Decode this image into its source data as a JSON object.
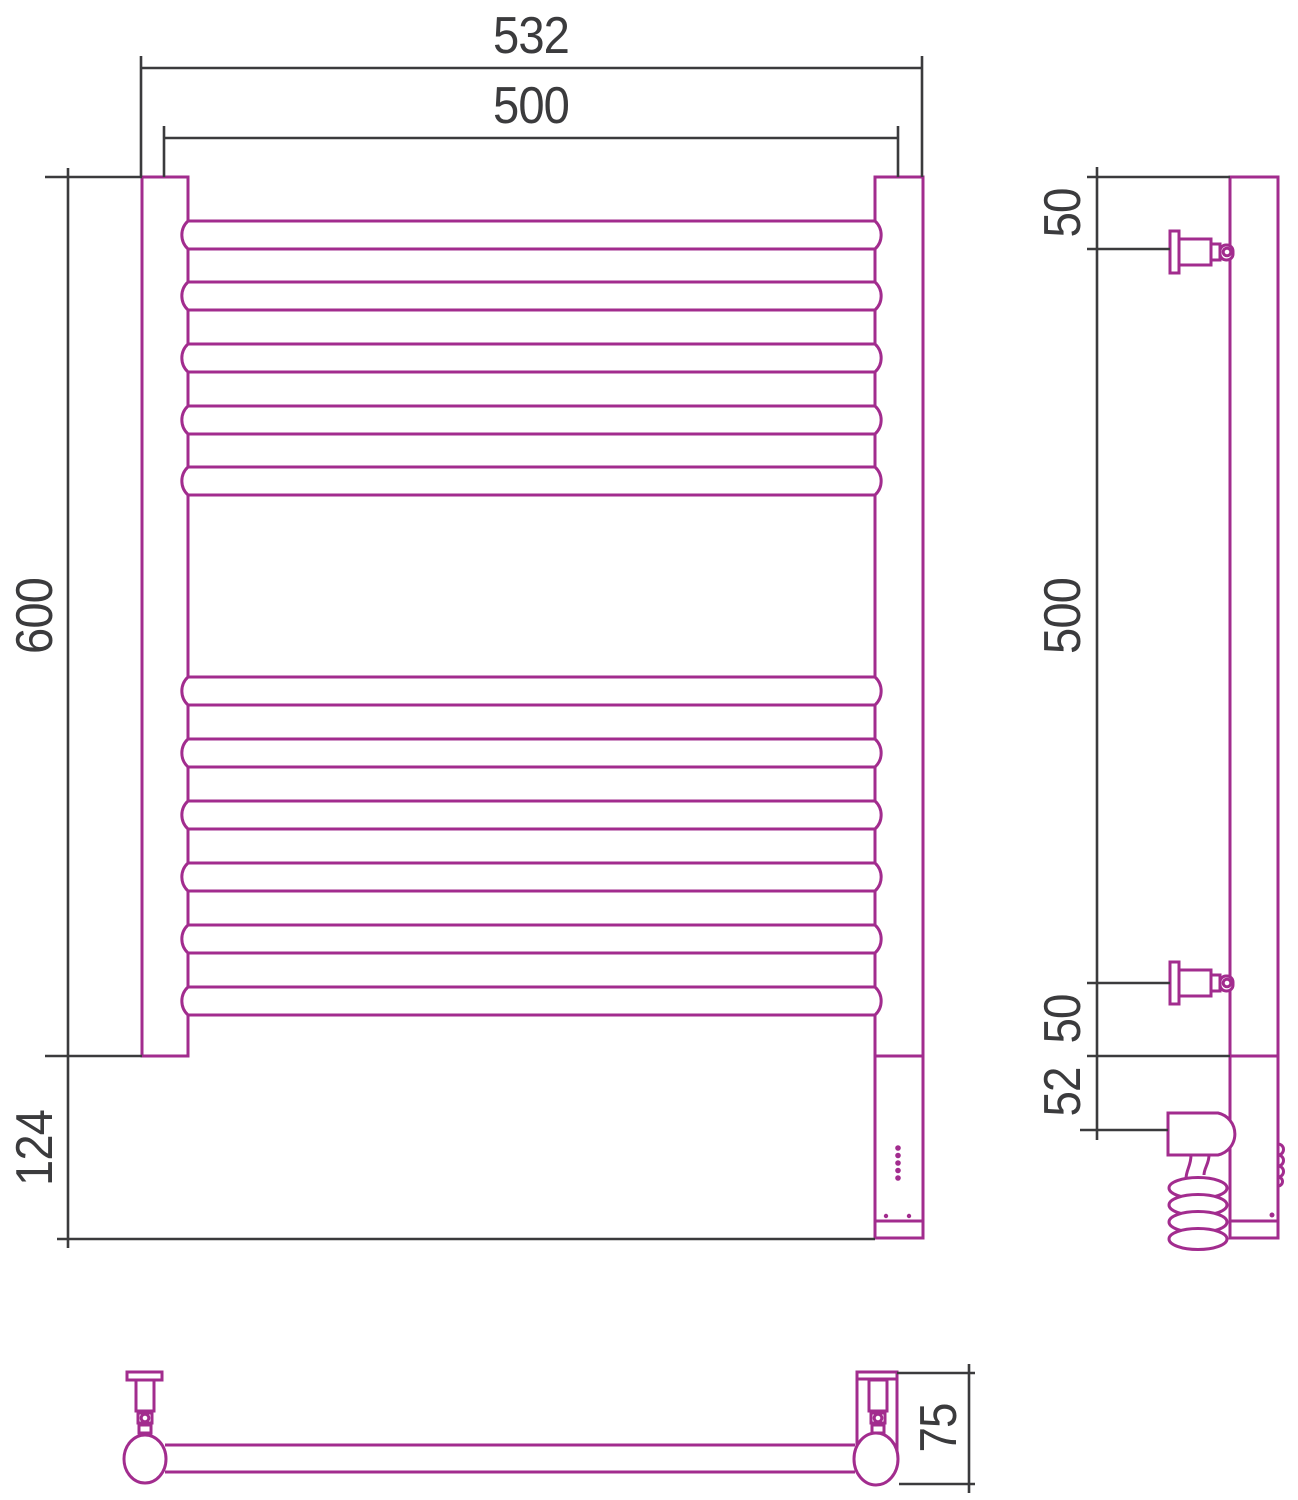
{
  "drawing": {
    "type": "technical dimensional drawing",
    "subject": "ladder towel rail (electric heated towel rack), three orthographic views",
    "views": [
      "front view",
      "side view",
      "bottom view"
    ],
    "colors": {
      "product_outline": "#a22c8e",
      "dimension_lines": "#3b3b3d",
      "background": "#ffffff"
    },
    "front_view": {
      "rungs_top_group": 5,
      "rungs_bottom_group": 6,
      "indicator_led_dots": 5,
      "dimensions": {
        "outer_width": "532",
        "rail_center_spacing": "500",
        "frame_height": "600",
        "lower_section_height": "124"
      }
    },
    "side_view": {
      "dimensions": {
        "top_bracket_offset": "50",
        "bracket_span": "500",
        "bottom_bracket_offset": "50",
        "element_offset": "52"
      }
    },
    "bottom_view": {
      "dimensions": {
        "depth": "75"
      }
    }
  }
}
